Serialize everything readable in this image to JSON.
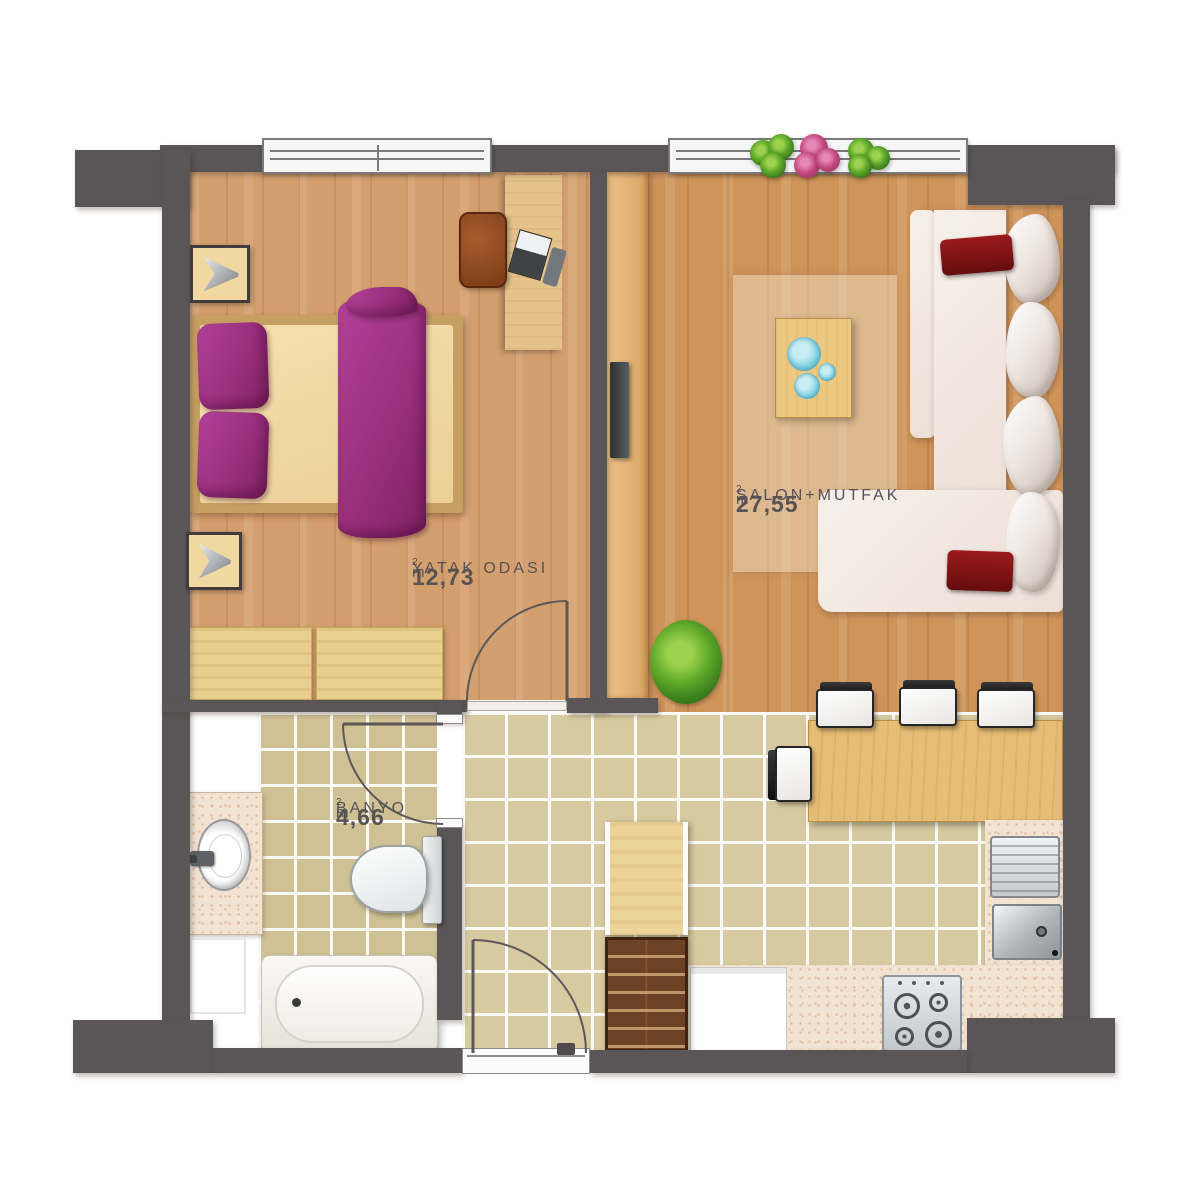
{
  "plan": {
    "rooms": [
      {
        "id": "bedroom",
        "name": "YATAK ODASI",
        "area": "12,73",
        "unit": "m",
        "unit_sup": "2"
      },
      {
        "id": "salon",
        "name": "SALON+MUTFAK",
        "area": "27,55",
        "unit": "m",
        "unit_sup": "2"
      },
      {
        "id": "bathroom",
        "name": "BANYO",
        "area": "4,66",
        "unit": "m",
        "unit_sup": "2"
      }
    ],
    "colors": {
      "wall": "#5a5657",
      "bedroom_floor": "#d49f6e",
      "salon_floor": "#cf945a",
      "hall_tiles": "#d8caa0",
      "bath_tiles": "#cfc193",
      "counter": "#f2e2d2",
      "bedding_magenta": "#9a2f7e",
      "sofa_cream": "#f1e9e3",
      "cushion_red": "#8e1216",
      "bowl_teal": "#7fd2e2",
      "plant_green": "#5ea829",
      "flower_pink": "#c2487f"
    },
    "furniture": [
      "double-bed",
      "wall-lamp",
      "dresser",
      "desk",
      "desk-chair",
      "laptop",
      "window",
      "tv-unit",
      "tv",
      "sofa",
      "rug",
      "coffee-table",
      "floor-plant",
      "window-plants",
      "dining-table",
      "dining-chair",
      "kitchen-counter",
      "drainboard",
      "kitchen-sink",
      "stove",
      "appliance",
      "shoe-cabinet",
      "hall-cabinet",
      "vanity-counter",
      "wash-basin",
      "faucet",
      "toilet",
      "bathtub",
      "door-swing"
    ]
  }
}
